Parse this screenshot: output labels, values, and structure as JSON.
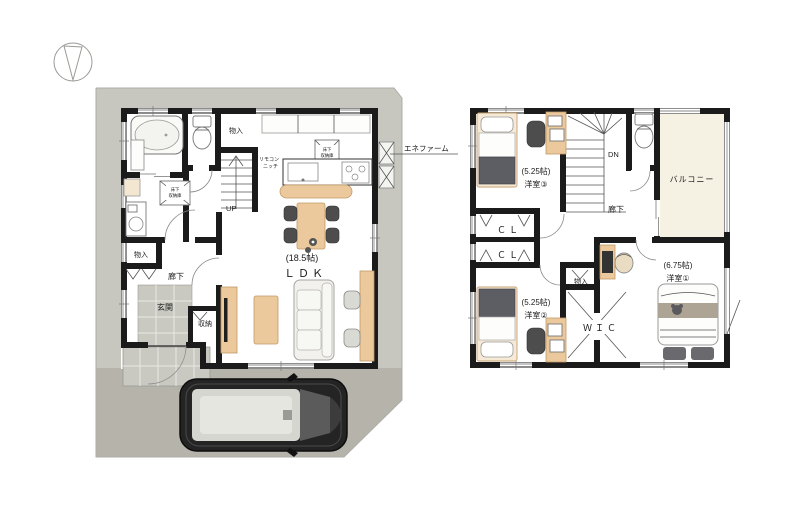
{
  "document": {
    "type": "floor-plan",
    "background": "#ffffff"
  },
  "compass": {
    "icon": "north-arrow"
  },
  "floor1": {
    "labels": {
      "storage_top": "物入",
      "remote_niche_l1": "リモコン",
      "remote_niche_l2": "ニッチ",
      "underfloor_l1": "床下",
      "underfloor_l2": "収納庫",
      "up": "UP",
      "storage_left": "物入",
      "hallway": "廊下",
      "entrance": "玄関",
      "entrance_storage": "収納",
      "ldk_size": "(18.5帖)",
      "ldk_name": "ＬＤＫ",
      "enefarm": "エネファーム"
    }
  },
  "floor2": {
    "labels": {
      "room3_size": "(5.25帖)",
      "room3_name": "洋室③",
      "down": "DN",
      "hallway": "廊下",
      "balcony": "バルコニー",
      "closet1": "ＣＬ",
      "closet2": "ＣＬ",
      "room2_size": "(5.25帖)",
      "room2_name": "洋室②",
      "storage": "物入",
      "wic": "ＷＩＣ",
      "room1_size": "(6.75帖)",
      "room1_name": "洋室①"
    }
  },
  "colors": {
    "wall": "#1b1b1b",
    "site": "#c7c7c0",
    "driveway": "#b6b3aa",
    "tile": "#c9c9c2",
    "wood": "#ecc99c",
    "balcony": "#f5f2e3",
    "fabric_dark": "#5d5d64",
    "sofa": "#f2f1ed"
  }
}
